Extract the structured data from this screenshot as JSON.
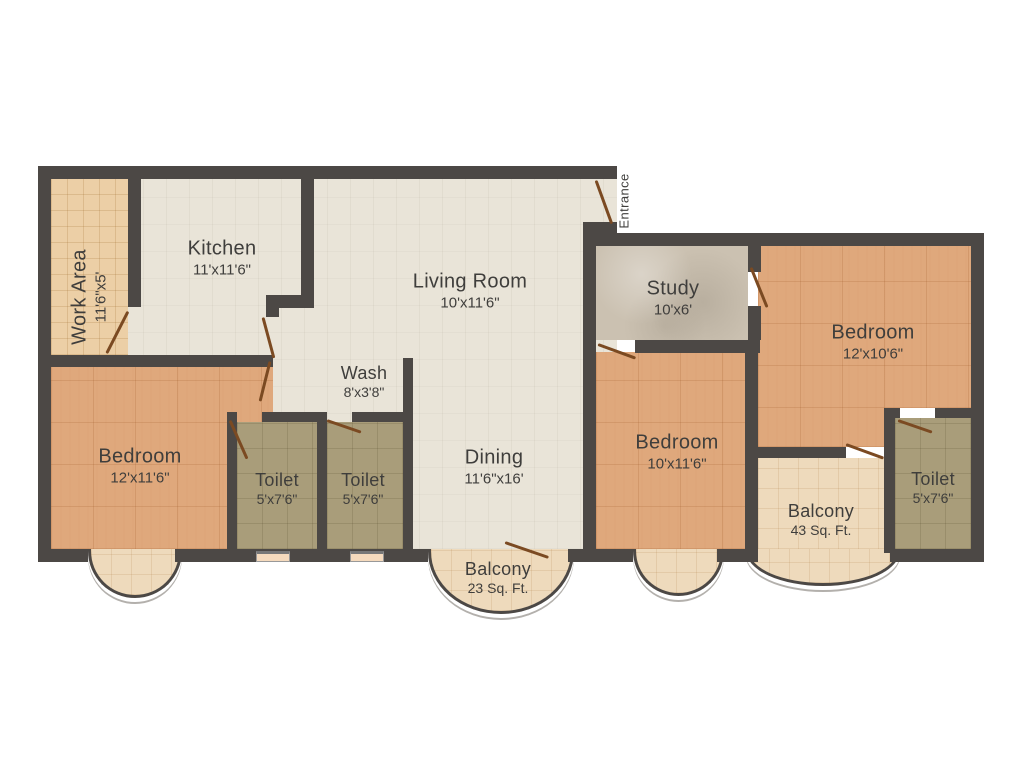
{
  "palette": {
    "wall": "#4c4845",
    "floor_cream": "#e9e4d8",
    "floor_work_area": "#eccfa6",
    "floor_bedroom": "#dfa87c",
    "floor_toilet": "#a99d7a",
    "floor_study": "#cbc1b1",
    "floor_balcony": "#eedabc",
    "door": "#7b4a22",
    "label_text": "#3f3e3c",
    "outside": "#ffffff"
  },
  "rooms": {
    "work_area": {
      "name": "Work Area",
      "dims": "11'6\"x5'"
    },
    "kitchen": {
      "name": "Kitchen",
      "dims": "11'x11'6\""
    },
    "living_room": {
      "name": "Living Room",
      "dims": "10'x11'6\""
    },
    "entrance": {
      "name": "Entrance"
    },
    "study": {
      "name": "Study",
      "dims": "10'x6'"
    },
    "bedroom_right": {
      "name": "Bedroom",
      "dims": "12'x10'6\""
    },
    "wash": {
      "name": "Wash",
      "dims": "8'x3'8\""
    },
    "dining": {
      "name": "Dining",
      "dims": "11'6\"x16'"
    },
    "bedroom_center": {
      "name": "Bedroom",
      "dims": "10'x11'6\""
    },
    "bedroom_left": {
      "name": "Bedroom",
      "dims": "12'x11'6\""
    },
    "toilet_left": {
      "name": "Toilet",
      "dims": "5'x7'6\""
    },
    "toilet_mid": {
      "name": "Toilet",
      "dims": "5'x7'6\""
    },
    "toilet_right": {
      "name": "Toilet",
      "dims": "5'x7'6\""
    },
    "balcony_small": {
      "name": "Balcony",
      "dims": "23 Sq. Ft."
    },
    "balcony_large": {
      "name": "Balcony",
      "dims": "43 Sq. Ft."
    }
  }
}
